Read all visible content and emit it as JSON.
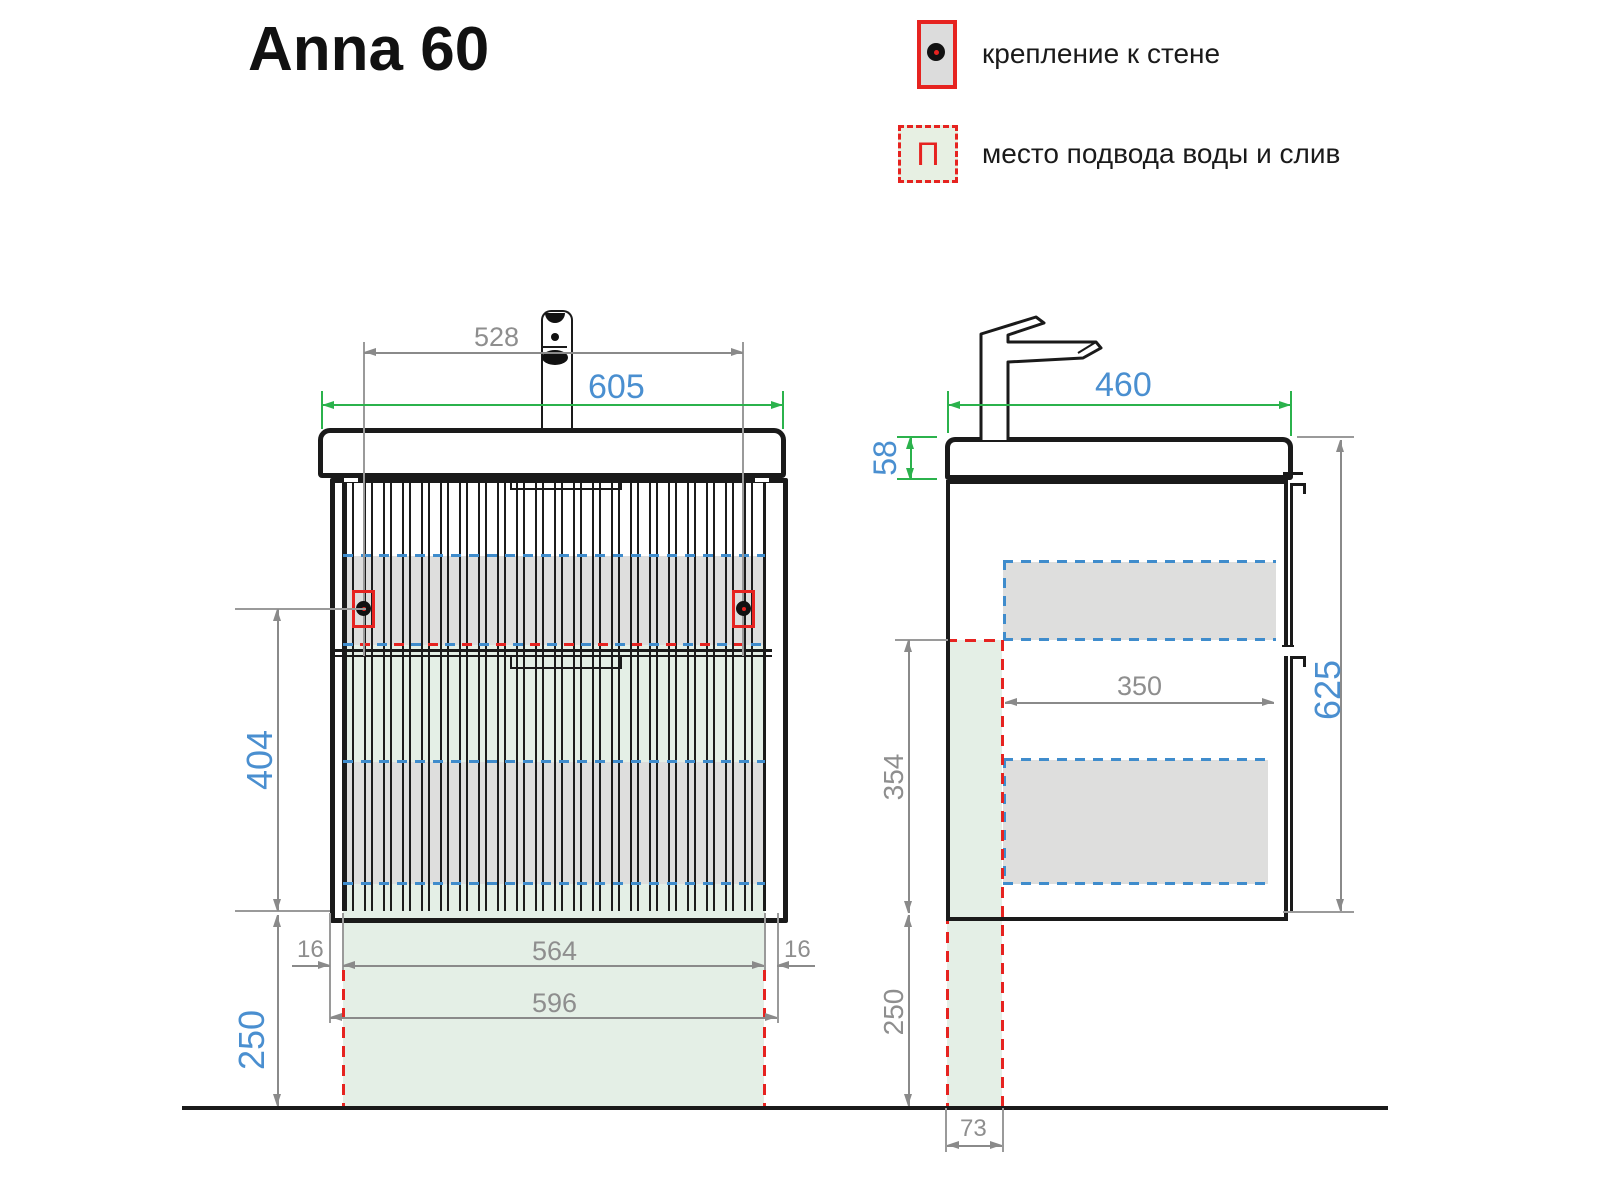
{
  "title": "Anna 60",
  "legend": {
    "wall_mount_label": "крепление к стене",
    "water_supply_label": "место подвода воды и слив",
    "water_supply_symbol": "П"
  },
  "colors": {
    "dim_gray": "#8a8a8a",
    "dim_green": "#2bb24c",
    "label_blue": "#4a8fd0",
    "marker_red": "#e62320",
    "dash_blue": "#3f8ccc",
    "zone_green": "#e4efe6",
    "zone_gray": "#dededd",
    "ink": "#1a1a1a"
  },
  "front_view": {
    "dims": {
      "faucet_span": "528",
      "sink_width": "605",
      "body_height": "404",
      "floor_clearance": "250",
      "side_panel_left": "16",
      "inner_width": "564",
      "side_panel_right": "16",
      "cabinet_width": "596"
    }
  },
  "side_view": {
    "dims": {
      "sink_depth": "460",
      "sink_height": "58",
      "total_height": "625",
      "inner_depth": "350",
      "mount_zone_height": "354",
      "floor_clearance": "250",
      "drain_offset": "73"
    }
  }
}
